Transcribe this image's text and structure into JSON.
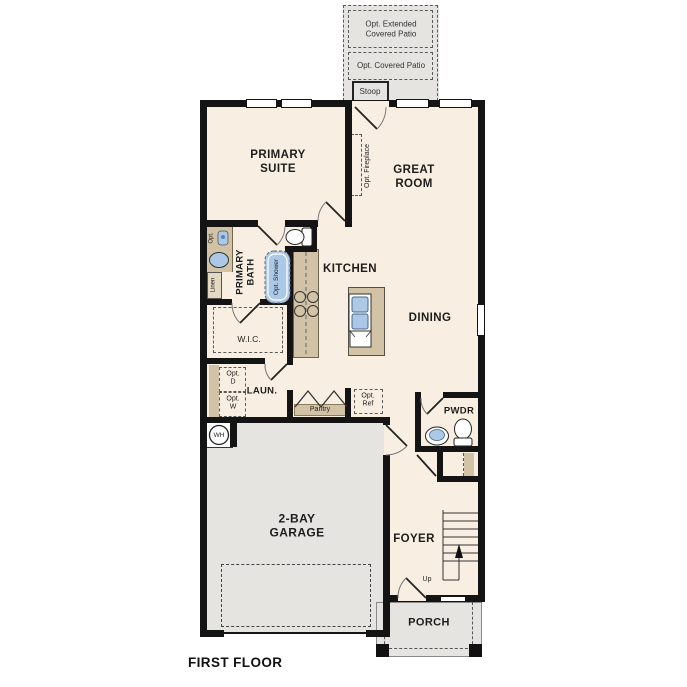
{
  "plan": {
    "floor_title": "FIRST FLOOR",
    "outdoor": {
      "extended_patio_label": "Opt. Extended\nCovered Patio",
      "covered_patio_label": "Opt. Covered Patio",
      "stoop_label": "Stoop",
      "porch_label": "PORCH"
    },
    "rooms": {
      "primary_suite": "PRIMARY\nSUITE",
      "great_room": "GREAT\nROOM",
      "kitchen": "KITCHEN",
      "dining": "DINING",
      "primary_bath": "PRIMARY\nBATH",
      "wic": "W.I.C.",
      "laundry": "LAUN.",
      "pantry": "Pantry",
      "powder": "PWDR",
      "garage": "2-BAY\nGARAGE",
      "foyer": "FOYER"
    },
    "annotations": {
      "opt_fireplace": "Opt. Fireplace",
      "opt_shower": "Opt. Shower",
      "opt_vanity": "Opt.",
      "linen": "Linen",
      "dishwasher": "DW",
      "opt_dryer": "Opt.\nD",
      "opt_washer": "Opt.\nW",
      "opt_refrigerator": "Opt.\nRef",
      "water_heater": "WH",
      "stairs_up": "Up"
    },
    "colors": {
      "floor": "#f8efe2",
      "outdoor_concrete": "#e6e4e0",
      "cabinetry": "#d2c3a6",
      "plumbing_fixture": "#abc9e6",
      "wall": "#141414",
      "text": "#1d1d1d"
    }
  }
}
